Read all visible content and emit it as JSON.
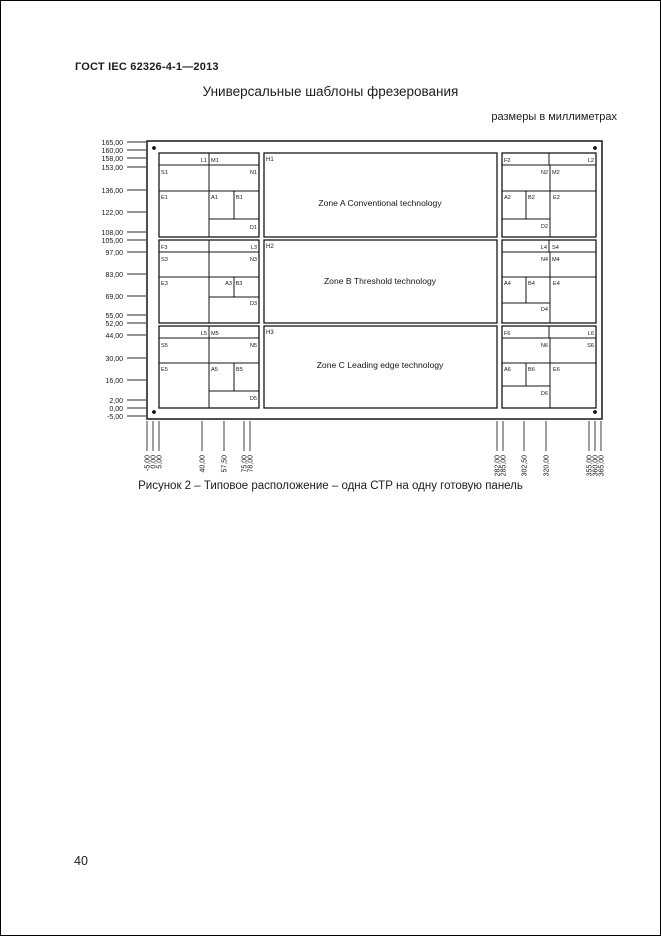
{
  "page": {
    "doc_code": "ГОСТ IEC 62326-4-1—2013",
    "title": "Универсальные шаблоны фрезерования",
    "units_note": "размеры в миллиметрах",
    "caption": "Рисунок 2 – Типовое расположение – одна СТР на одну готовую панель",
    "page_number": "40"
  },
  "diagram": {
    "y_ticks": [
      "165,00",
      "160,00",
      "158,00",
      "153,00",
      "136,00",
      "122,00",
      "108,00",
      "105,00",
      "97,00",
      "83,00",
      "69,00",
      "55,00",
      "52,00",
      "44,00",
      "30,00",
      "16,00",
      "2,00",
      "0,00",
      "-5,00"
    ],
    "x_ticks": [
      "-5,00",
      "0,00",
      "5,00",
      "40,00",
      "57,50",
      "75,00",
      "78,00",
      "282,00",
      "285,00",
      "302,50",
      "320,00",
      "355,00",
      "360,00",
      "365,00"
    ],
    "zones": [
      {
        "h_label": "H1",
        "title": "Zone A  Conventional technology",
        "left": {
          "top_a": "L1",
          "top_b": "M1",
          "mid_a": "S1",
          "mid_b": "N1",
          "e": "E1",
          "a": "A1",
          "b": "B1",
          "d": "D1"
        },
        "right": {
          "top_a": "F2",
          "top_b": "L2",
          "mid_a": "N2",
          "mid_b": "M2",
          "a": "A2",
          "b": "B2",
          "e": "E2",
          "d": "D2"
        }
      },
      {
        "h_label": "H2",
        "title": "Zone B  Threshold technology",
        "left": {
          "top_a": "F3",
          "top_b": "L3",
          "mid_a": "S3",
          "mid_b": "N3",
          "e": "E3",
          "a": "A3",
          "b": "B3",
          "d": "D3"
        },
        "right": {
          "top_a": "L4",
          "top_b": "S4",
          "mid_a": "N4",
          "mid_b": "M4",
          "a": "A4",
          "b": "B4",
          "e": "E4",
          "d": "D4"
        }
      },
      {
        "h_label": "H3",
        "title": "Zone C  Leading edge technology",
        "left": {
          "top_a": "L5",
          "top_b": "M5",
          "mid_a": "S5",
          "mid_b": "N5",
          "e": "E5",
          "a": "A5",
          "b": "B5",
          "d": "D5"
        },
        "right": {
          "top_a": "F6",
          "top_b": "L6",
          "mid_a": "N6",
          "mid_b": "S6",
          "a": "A6",
          "b": "B6",
          "e": "E6",
          "d": "D6"
        }
      }
    ]
  }
}
